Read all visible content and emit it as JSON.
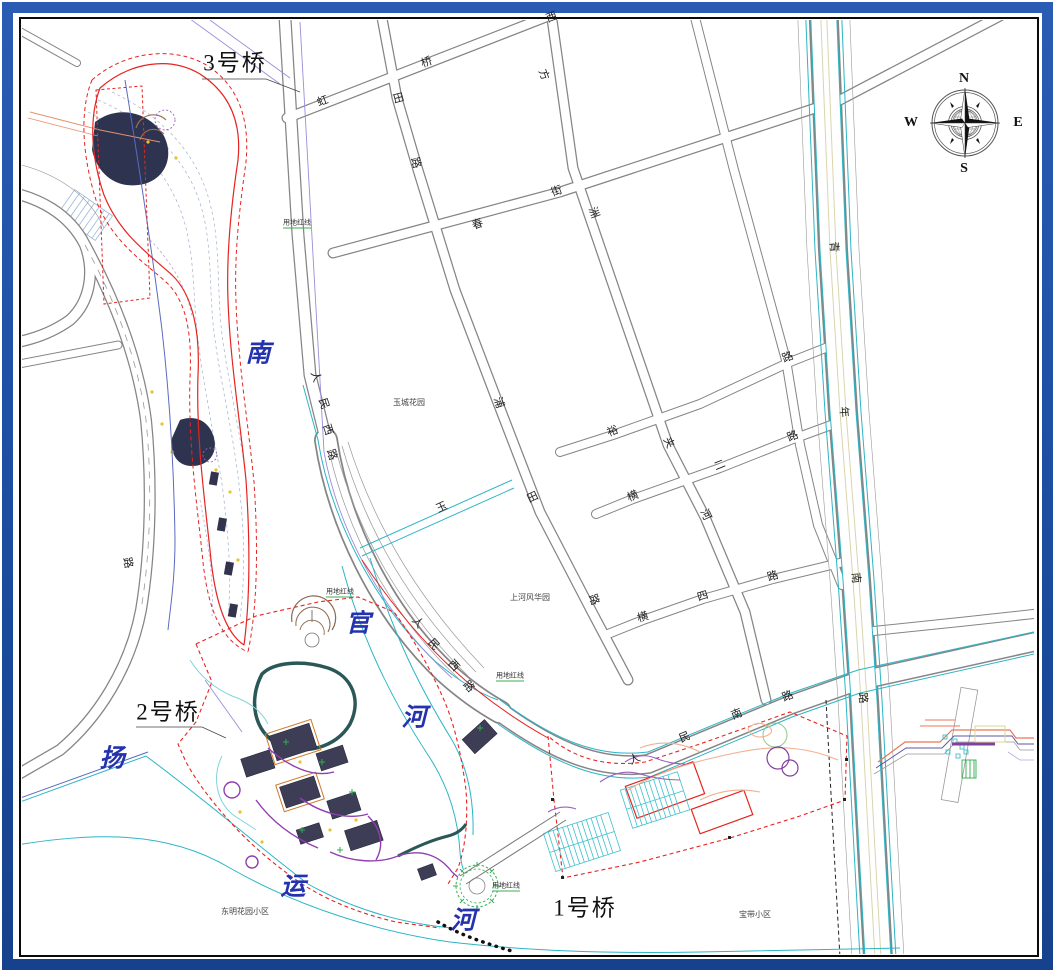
{
  "title": "landscape-planning-cad-site-plan",
  "colors": {
    "frame_blue": "#1d4fa3",
    "road_gray": "#858585",
    "canal_cyan": "#2cb5c5",
    "redline_red": "#e62420",
    "river_blue": "#5b6ac0",
    "bridge_axis_violet": "#9b8ed8",
    "river_text_blue": "#2433ad",
    "park_building": "#3d3d55",
    "park_path_purple": "#8f3fb0",
    "park_loop_teal": "#2a5858"
  },
  "bridge_labels": [
    {
      "text": "3号桥",
      "x": 235,
      "y": 63
    },
    {
      "text": "2号桥",
      "x": 168,
      "y": 712
    },
    {
      "text": "1号桥",
      "x": 585,
      "y": 908
    }
  ],
  "river_labels": [
    {
      "text": "南",
      "x": 258,
      "y": 354
    },
    {
      "text": "官",
      "x": 358,
      "y": 624
    },
    {
      "text": "河",
      "x": 414,
      "y": 718
    },
    {
      "text": "扬",
      "x": 112,
      "y": 759
    },
    {
      "text": "运",
      "x": 293,
      "y": 887
    },
    {
      "text": "河",
      "x": 463,
      "y": 921
    }
  ],
  "road_labels": [
    {
      "text": "虹",
      "x": 323,
      "y": 102,
      "r": -20
    },
    {
      "text": "桥",
      "x": 427,
      "y": 63,
      "r": -20
    },
    {
      "text": "西",
      "x": 552,
      "y": 18,
      "r": -20
    },
    {
      "text": "方",
      "x": 543,
      "y": 75,
      "r": 70
    },
    {
      "text": "洲",
      "x": 593,
      "y": 213,
      "r": 70
    },
    {
      "text": "田",
      "x": 397,
      "y": 98,
      "r": 75
    },
    {
      "text": "路",
      "x": 415,
      "y": 163,
      "r": 75
    },
    {
      "text": "春",
      "x": 478,
      "y": 225,
      "r": -20
    },
    {
      "text": "街",
      "x": 557,
      "y": 192,
      "r": -20
    },
    {
      "text": "人",
      "x": 315,
      "y": 377,
      "r": 72
    },
    {
      "text": "民",
      "x": 323,
      "y": 404,
      "r": 72
    },
    {
      "text": "西",
      "x": 327,
      "y": 430,
      "r": 72
    },
    {
      "text": "路",
      "x": 331,
      "y": 455,
      "r": 72
    },
    {
      "text": "浦",
      "x": 498,
      "y": 403,
      "r": 72
    },
    {
      "text": "玉",
      "x": 442,
      "y": 508,
      "r": -25
    },
    {
      "text": "田",
      "x": 533,
      "y": 498,
      "r": -25
    },
    {
      "text": "裕",
      "x": 613,
      "y": 432,
      "r": -22
    },
    {
      "text": "路",
      "x": 788,
      "y": 358,
      "r": -22
    },
    {
      "text": "二",
      "x": 720,
      "y": 466,
      "r": -22
    },
    {
      "text": "路",
      "x": 793,
      "y": 437,
      "r": -22
    },
    {
      "text": "横",
      "x": 633,
      "y": 497,
      "r": -22
    },
    {
      "text": "夹",
      "x": 668,
      "y": 443,
      "r": 65
    },
    {
      "text": "河",
      "x": 705,
      "y": 515,
      "r": 65
    },
    {
      "text": "横",
      "x": 643,
      "y": 618,
      "r": -17
    },
    {
      "text": "四",
      "x": 703,
      "y": 597,
      "r": -17
    },
    {
      "text": "路",
      "x": 773,
      "y": 577,
      "r": -17
    },
    {
      "text": "路",
      "x": 593,
      "y": 600,
      "r": 70
    },
    {
      "text": "人",
      "x": 417,
      "y": 623,
      "r": 48
    },
    {
      "text": "民",
      "x": 433,
      "y": 645,
      "r": 48
    },
    {
      "text": "西",
      "x": 453,
      "y": 666,
      "r": 48
    },
    {
      "text": "路",
      "x": 468,
      "y": 687,
      "r": 48
    },
    {
      "text": "人",
      "x": 635,
      "y": 760,
      "r": -22
    },
    {
      "text": "民",
      "x": 685,
      "y": 738,
      "r": -22
    },
    {
      "text": "南",
      "x": 737,
      "y": 715,
      "r": -22
    },
    {
      "text": "路",
      "x": 788,
      "y": 697,
      "r": -22
    },
    {
      "text": "青",
      "x": 833,
      "y": 247,
      "r": 85
    },
    {
      "text": "年",
      "x": 843,
      "y": 412,
      "r": 85
    },
    {
      "text": "南",
      "x": 855,
      "y": 578,
      "r": 85
    },
    {
      "text": "路",
      "x": 862,
      "y": 698,
      "r": 85
    },
    {
      "text": "路",
      "x": 127,
      "y": 563,
      "r": 78
    }
  ],
  "area_labels": [
    {
      "text": "玉城花园",
      "x": 409,
      "y": 403
    },
    {
      "text": "上河风华园",
      "x": 530,
      "y": 598
    },
    {
      "text": "东明花园小区",
      "x": 245,
      "y": 912
    },
    {
      "text": "宝带小区",
      "x": 755,
      "y": 915
    }
  ],
  "redline_labels": [
    {
      "text": "用地红线",
      "x": 297,
      "y": 224
    },
    {
      "text": "用地红线",
      "x": 340,
      "y": 593
    },
    {
      "text": "用地红线",
      "x": 510,
      "y": 677
    },
    {
      "text": "用地红线",
      "x": 506,
      "y": 887
    }
  ],
  "compass": {
    "letters": [
      {
        "text": "N",
        "x": 964,
        "y": 79
      },
      {
        "text": "E",
        "x": 1018,
        "y": 123
      },
      {
        "text": "S",
        "x": 964,
        "y": 169
      },
      {
        "text": "W",
        "x": 911,
        "y": 123
      }
    ]
  }
}
